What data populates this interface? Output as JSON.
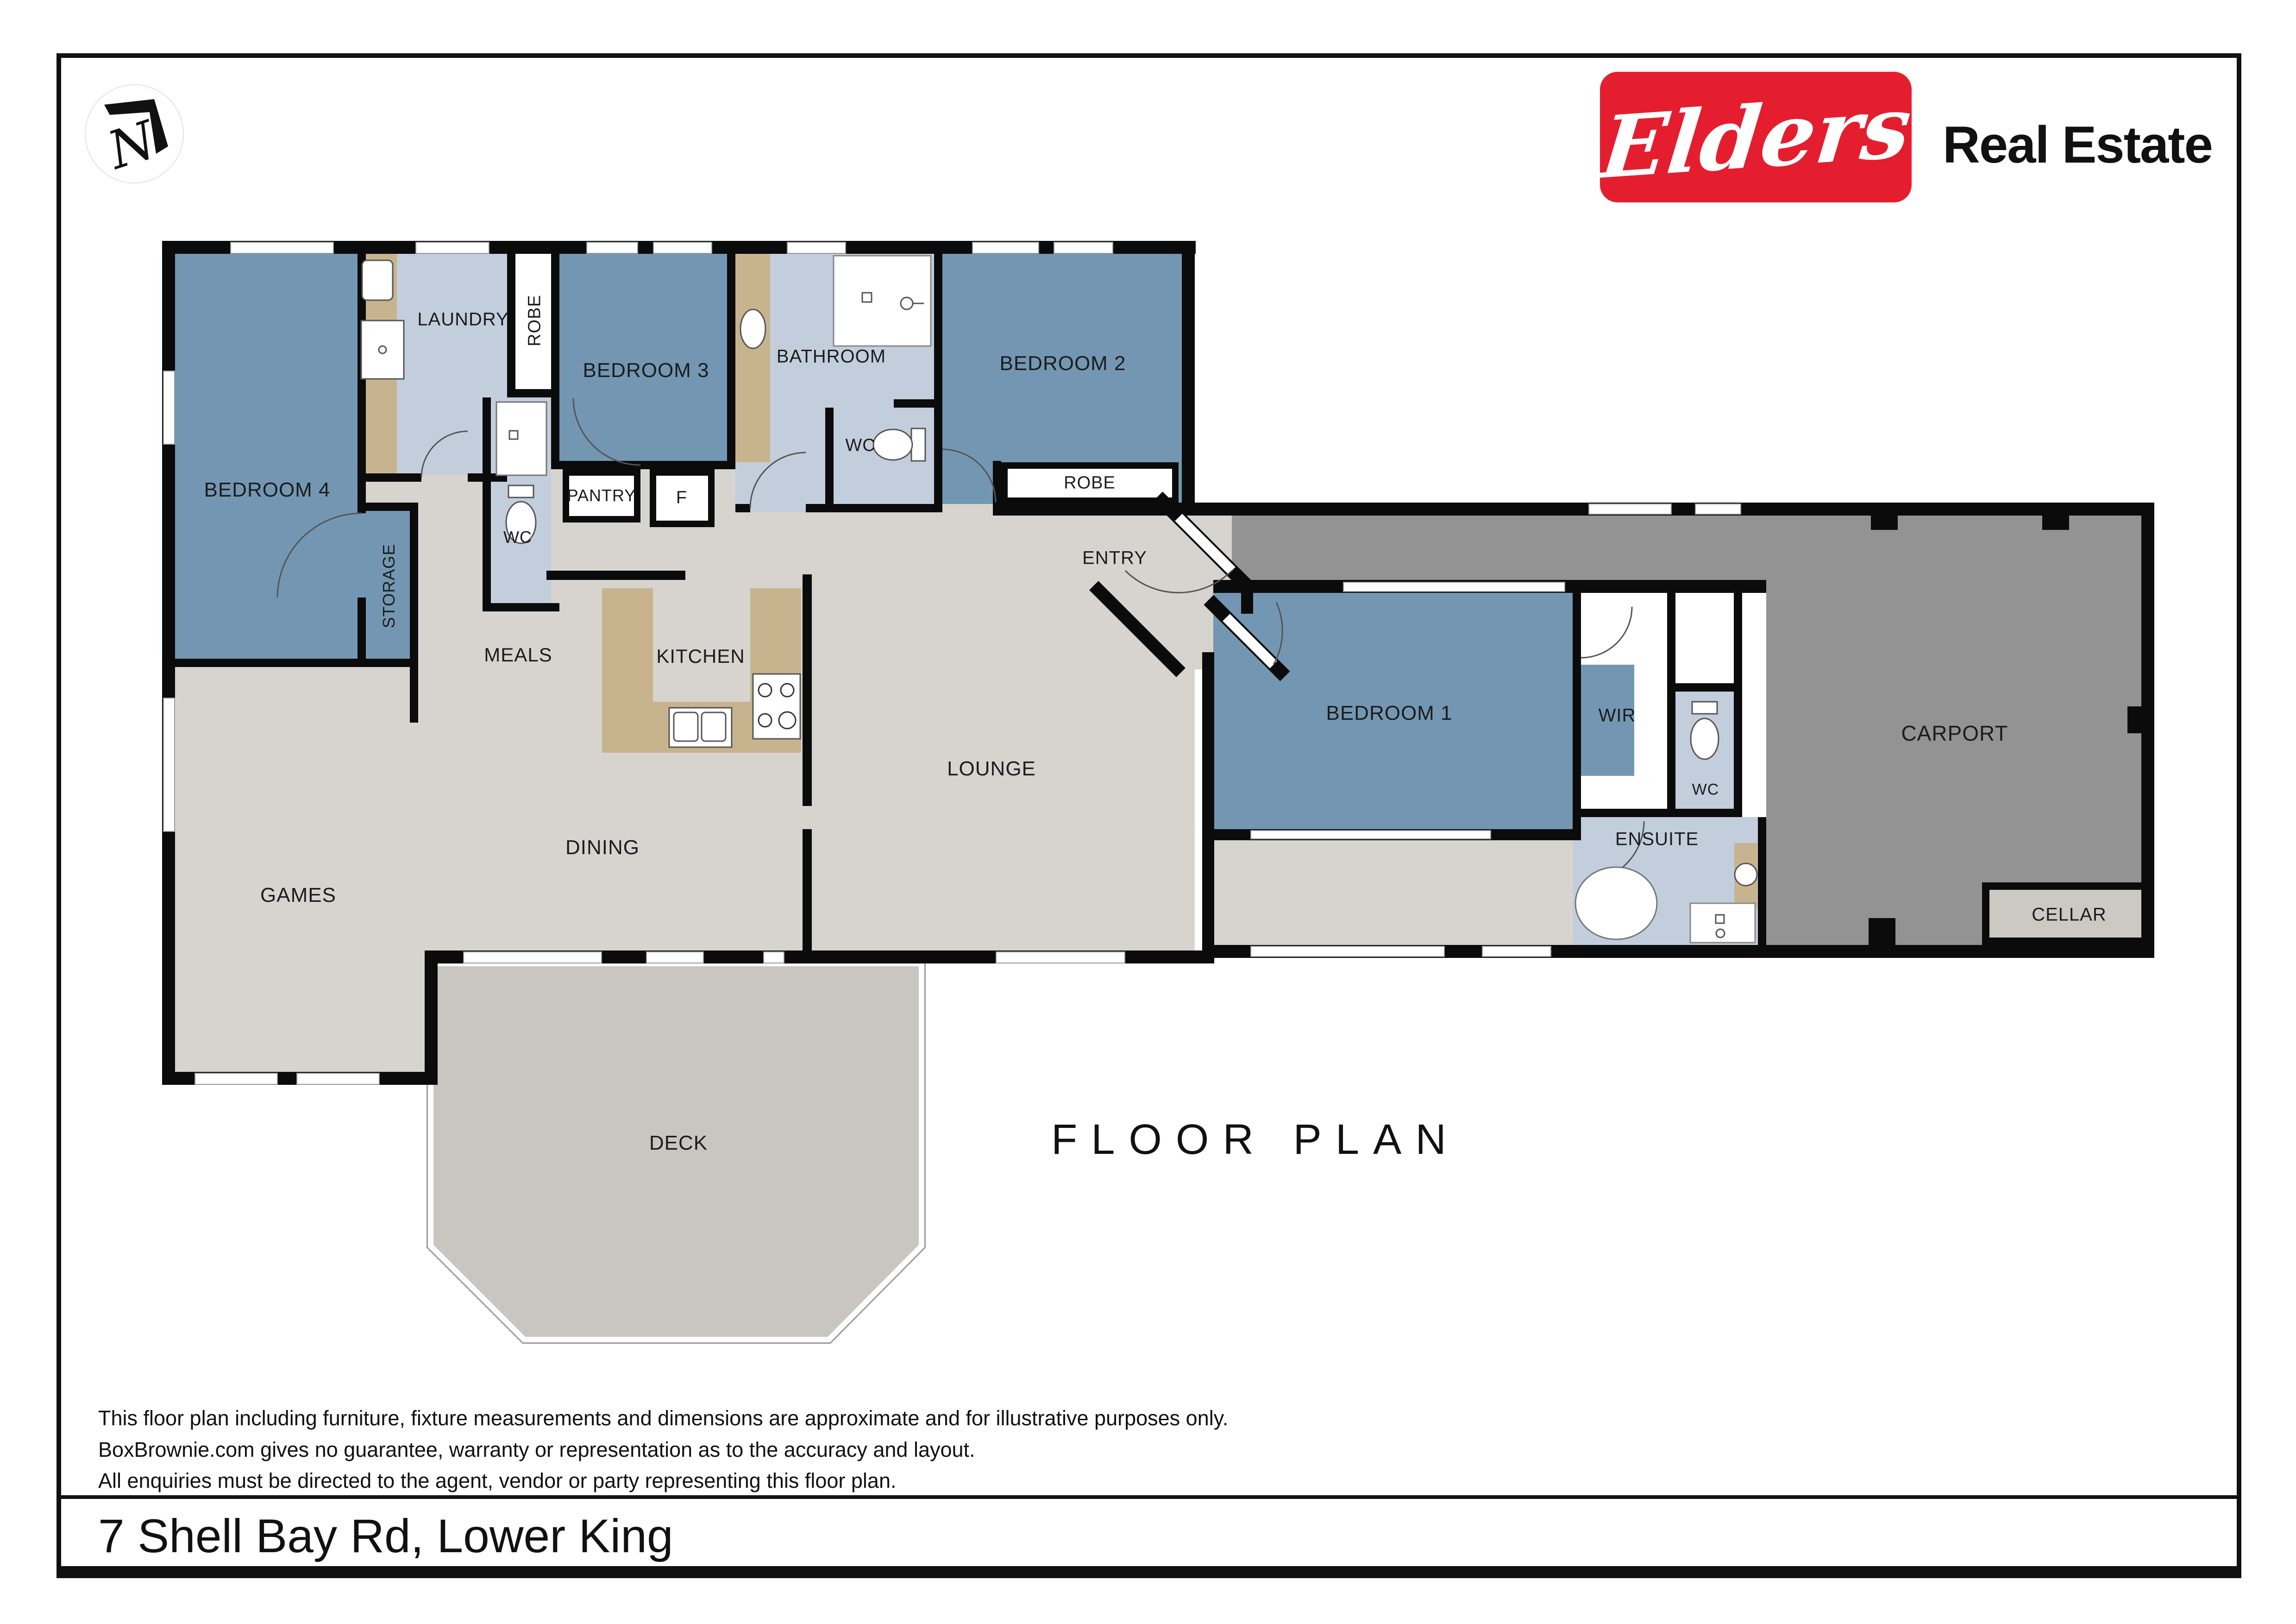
{
  "brand": {
    "logo_text": "Elders",
    "suffix": "Real Estate",
    "logo_red": "#e41e2e",
    "compass_letter": "N"
  },
  "title": "FLOOR PLAN",
  "address": "7 Shell Bay Rd, Lower King",
  "disclaimer": {
    "line1": "This floor plan including furniture, fixture measurements and dimensions are approximate and for illustrative purposes only.",
    "line2": "BoxBrownie.com gives no guarantee, warranty or representation as to the accuracy and layout.",
    "line3": "All enquiries must be directed to the agent, vendor or party representing this floor plan."
  },
  "rooms": {
    "bedroom4": {
      "label": "BEDROOM 4"
    },
    "laundry": {
      "label": "LAUNDRY"
    },
    "robe1": {
      "label": "ROBE"
    },
    "wc_laundry": {
      "label": "WC"
    },
    "bedroom3": {
      "label": "BEDROOM 3"
    },
    "pantry": {
      "label": "PANTRY"
    },
    "fridge": {
      "label": "F"
    },
    "bathroom": {
      "label": "BATHROOM"
    },
    "wc_bathroom": {
      "label": "WC"
    },
    "bedroom2": {
      "label": "BEDROOM 2"
    },
    "robe2": {
      "label": "ROBE"
    },
    "storage": {
      "label": "STORAGE"
    },
    "meals": {
      "label": "MEALS"
    },
    "kitchen": {
      "label": "KITCHEN"
    },
    "entry": {
      "label": "ENTRY"
    },
    "lounge": {
      "label": "LOUNGE"
    },
    "dining": {
      "label": "DINING"
    },
    "games": {
      "label": "GAMES"
    },
    "deck": {
      "label": "DECK"
    },
    "bedroom1": {
      "label": "BEDROOM 1"
    },
    "wir": {
      "label": "WIR"
    },
    "wc_ensuite": {
      "label": "WC"
    },
    "ensuite": {
      "label": "ENSUITE"
    },
    "carport": {
      "label": "CARPORT"
    },
    "cellar": {
      "label": "CELLAR"
    }
  },
  "colors": {
    "bedroom_blue": "#7397b2",
    "wet_area_blue": "#c3cedd",
    "floor_gray": "#d7d4cf",
    "carport_gray": "#939393",
    "deck_gray": "#c9c6c1",
    "cellar_gray": "#ccc9c3",
    "bench_tan": "#c7b48f",
    "wall_black": "#0b0b0b"
  }
}
